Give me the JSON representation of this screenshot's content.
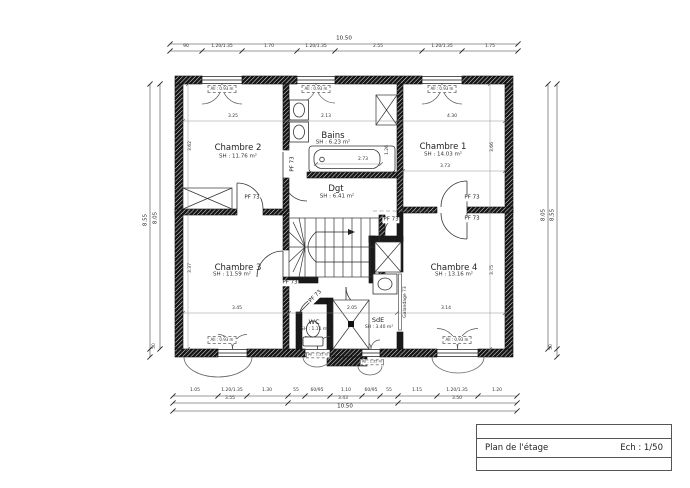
{
  "colors": {
    "ink": "#1a1a1a",
    "dim_lines": "#555555",
    "paper": "#ffffff"
  },
  "title_block": {
    "title": "Plan de l'étage",
    "scale": "Ech : 1/50"
  },
  "rooms": {
    "chambre1": {
      "name": "Chambre 1",
      "area": "SH : 14.03 m²"
    },
    "chambre2": {
      "name": "Chambre 2",
      "area": "SH : 11.76 m²"
    },
    "chambre3": {
      "name": "Chambre 3",
      "area": "SH : 11.59 m²"
    },
    "chambre4": {
      "name": "Chambre 4",
      "area": "SH : 13.16 m²"
    },
    "bains": {
      "name": "Bains",
      "area": "SH : 6.23 m²"
    },
    "dgt": {
      "name": "Dgt",
      "area": "SH : 6.41 m²"
    },
    "wc": {
      "name": "WC",
      "area": "SH : 1.11 m²"
    },
    "sde": {
      "name": "SdE",
      "area": "SH : 3.40 m²"
    }
  },
  "doors": {
    "swing_label": "PF 73",
    "sliding_label": "Galandage 73"
  },
  "windows": {
    "sill_standard": "All : 0.93 m",
    "sill_small": "All : 1.35 m"
  },
  "dims": {
    "top": {
      "total": "10.50",
      "segments": [
        "90",
        "1.20/1.35",
        "1.70",
        "1.20/1.35",
        "2.55",
        "1.20/1.35",
        "1.75"
      ]
    },
    "bottom": {
      "row1": [
        "1.05",
        "1.20/1.35",
        "1.30",
        "55",
        "60/95",
        "1.10",
        "60/95",
        "55",
        "1.15",
        "1.20/1.35",
        "1.20"
      ],
      "row2": [
        "3.55",
        "3.43",
        "3.50"
      ],
      "total": "10.50"
    },
    "left": {
      "outer": "8.55",
      "inner": "8.05",
      "base": "50"
    },
    "right": {
      "outer": "8.55",
      "inner": "8.05",
      "base": "50"
    },
    "interior": {
      "ch2_w": "3.25",
      "bains_w": "2.13",
      "ch1_w": "4.30",
      "ch1_w2": "3.73",
      "tub_w": "2.73",
      "ch3_w": "3.45",
      "sde_w": "2.05",
      "ch4_w": "3.14",
      "ch2_h": "3.62",
      "ch3_h": "3.37",
      "ch1_h": "3.66",
      "ch4_h": "3.75",
      "duct_h": "1.26"
    }
  }
}
